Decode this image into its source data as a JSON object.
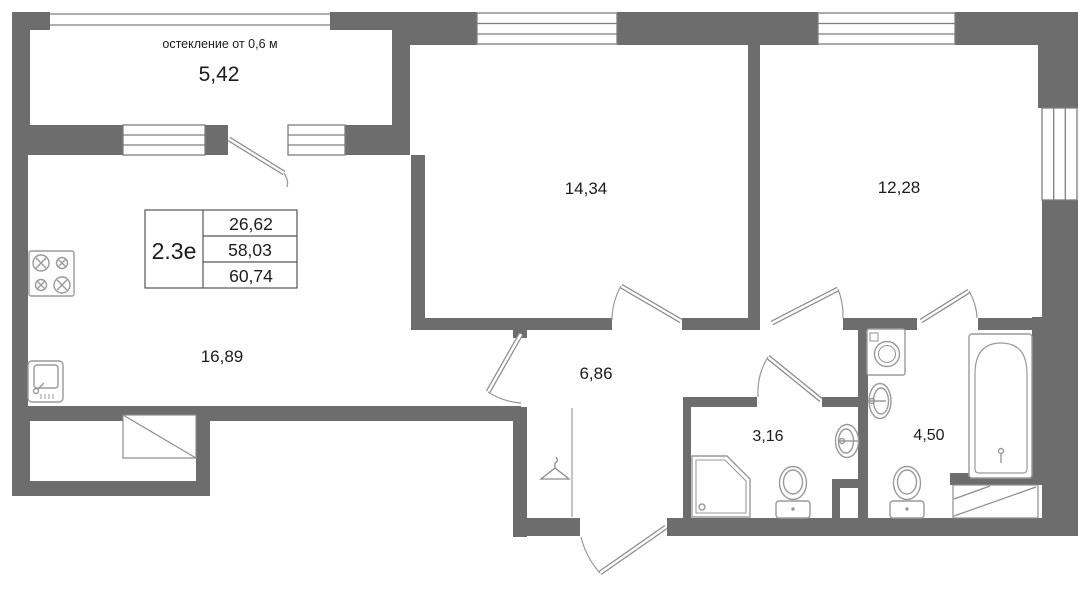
{
  "plan": {
    "unit_type": "2.3е",
    "stats": [
      "26,62",
      "58,03",
      "60,74"
    ],
    "glazing_note": "остекление от 0,6 м",
    "rooms": {
      "balcony": "5,42",
      "bedroom_1": "14,34",
      "bedroom_2": "12,28",
      "kitchen_living": "16,89",
      "hall": "6,86",
      "bathroom_small": "3,16",
      "bathroom_large": "4,50"
    },
    "colors": {
      "wall": "#6d6d6d",
      "fixture_line": "#9a9a9a",
      "door_line": "#8f8f8f",
      "text": "#1c1c1c"
    }
  }
}
